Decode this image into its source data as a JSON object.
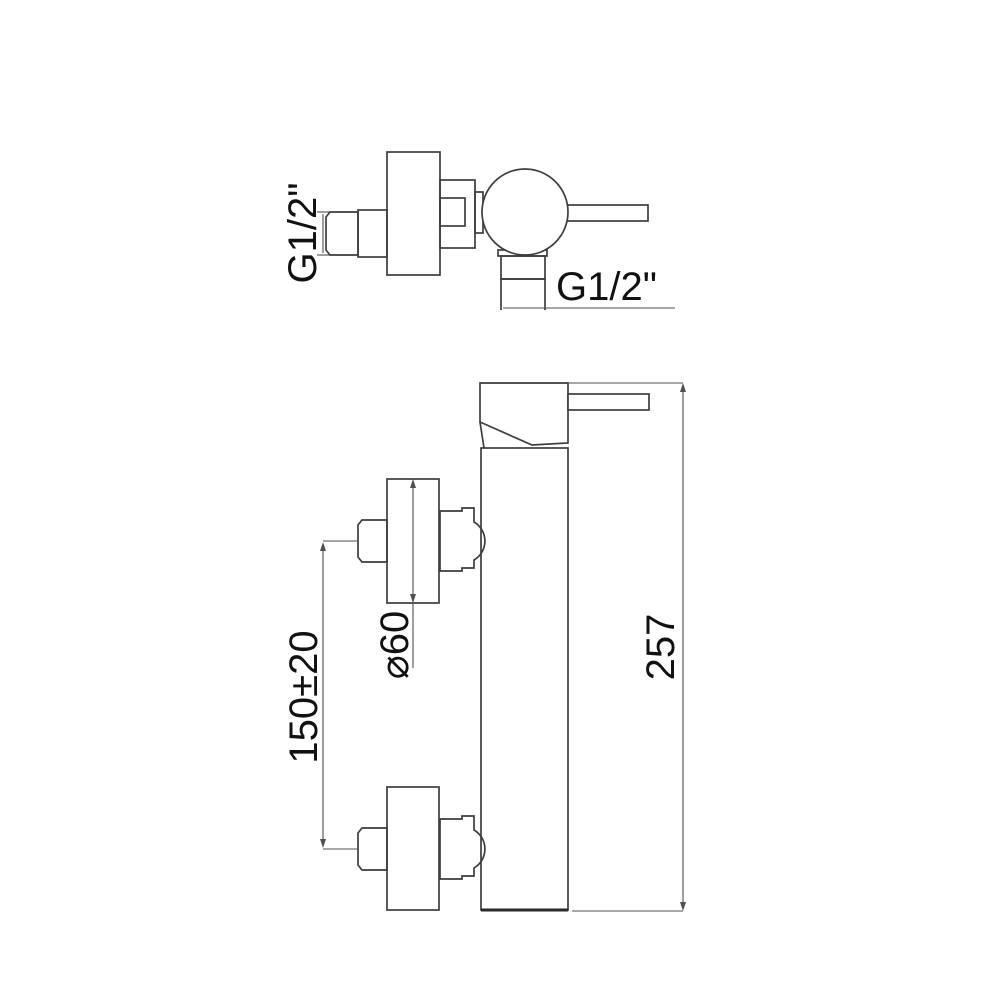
{
  "colors": {
    "background": "#ffffff",
    "object_line": "#3d3d3d",
    "dimension_line": "#4f4f4f",
    "text": "#111111"
  },
  "side_view": {
    "inlet_thread_label": "G1/2\"",
    "outlet_thread_label": "G1/2\""
  },
  "front_view": {
    "body_height_label": "257",
    "connection_spacing_label": "150±20",
    "flange_diameter_label": "⌀60"
  }
}
